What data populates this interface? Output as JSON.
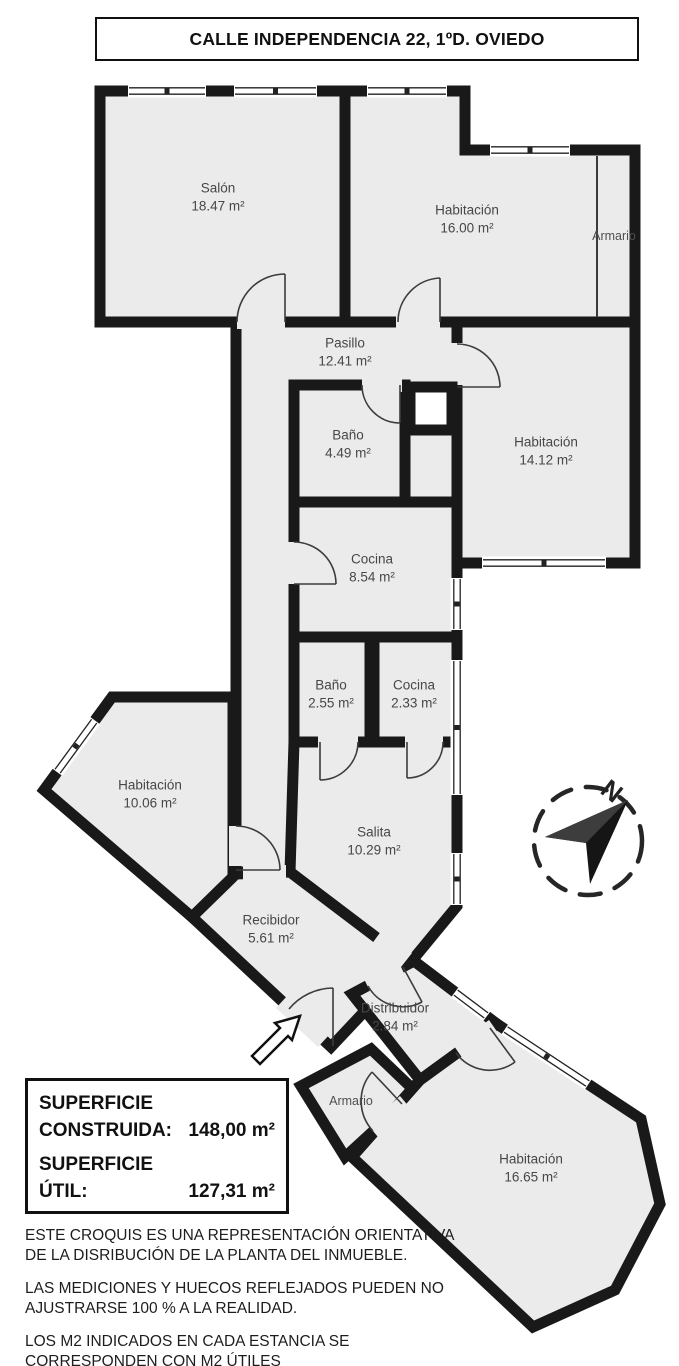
{
  "title": "CALLE INDEPENDENCIA 22, 1ºD. OVIEDO",
  "compass": {
    "north_label": "N"
  },
  "rooms": [
    {
      "id": "salon",
      "name": "Salón",
      "area": "18.47 m²"
    },
    {
      "id": "habitacion-16",
      "name": "Habitación",
      "area": "16.00 m²"
    },
    {
      "id": "armario-top",
      "name": "Armario",
      "area": ""
    },
    {
      "id": "pasillo",
      "name": "Pasillo",
      "area": "12.41 m²"
    },
    {
      "id": "bano-449",
      "name": "Baño",
      "area": "4.49 m²"
    },
    {
      "id": "habitacion-1412",
      "name": "Habitación",
      "area": "14.12 m²"
    },
    {
      "id": "cocina-854",
      "name": "Cocina",
      "area": "8.54 m²"
    },
    {
      "id": "bano-255",
      "name": "Baño",
      "area": "2.55 m²"
    },
    {
      "id": "cocina-233",
      "name": "Cocina",
      "area": "2.33 m²"
    },
    {
      "id": "habitacion-1006",
      "name": "Habitación",
      "area": "10.06 m²"
    },
    {
      "id": "salita",
      "name": "Salita",
      "area": "10.29 m²"
    },
    {
      "id": "recibidor",
      "name": "Recibidor",
      "area": "5.61 m²"
    },
    {
      "id": "distribuidor",
      "name": "Distribuidor",
      "area": "2.84 m²"
    },
    {
      "id": "armario-bottom",
      "name": "Armario",
      "area": ""
    },
    {
      "id": "habitacion-1665",
      "name": "Habitación",
      "area": "16.65 m²"
    }
  ],
  "summary": {
    "line1_label": "SUPERFICIE",
    "line2_label": "CONSTRUIDA:",
    "line2_value": "148,00 m²",
    "line3_label": "SUPERFICIE",
    "line4_label": "ÚTIL:",
    "line4_value": "127,31 m²"
  },
  "disclaimers": [
    "ESTE CROQUIS ES UNA REPRESENTACIÓN ORIENTATIVA DE LA DISRIBUCIÓN DE LA PLANTA DEL INMUEBLE.",
    "LAS MEDICIONES Y HUECOS REFLEJADOS PUEDEN NO AJUSTRARSE 100 % A LA REALIDAD.",
    "LOS M2 INDICADOS EN CADA ESTANCIA SE CORRESPONDEN CON M2 ÚTILES"
  ],
  "colors": {
    "wall": "#191919",
    "floor": "#ebebeb",
    "background": "#ffffff"
  }
}
